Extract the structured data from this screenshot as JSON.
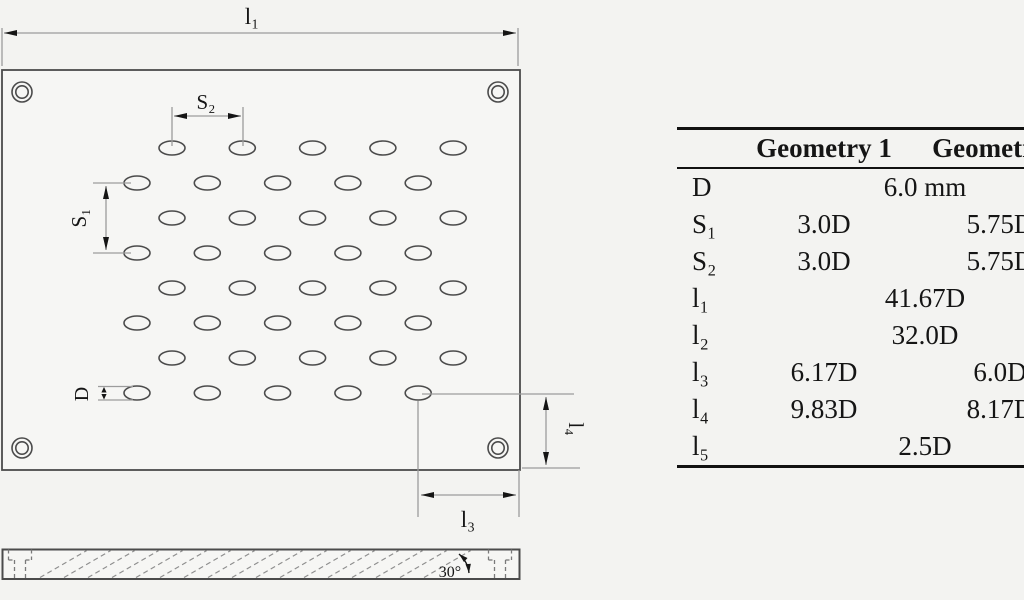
{
  "drawing": {
    "labels": {
      "l1": "l₁",
      "s2": "S₂",
      "s1": "S₁",
      "d": "D",
      "l4": "l₄",
      "l3": "l₃",
      "angle": "30°"
    },
    "plate": {
      "x": 2,
      "y": 70,
      "w": 518,
      "h": 400
    },
    "corner_holes": {
      "centers": [
        [
          22,
          92
        ],
        [
          498,
          92
        ],
        [
          22,
          448
        ],
        [
          498,
          448
        ]
      ],
      "r_outer": 10,
      "r_inner": 6.2
    },
    "hole_grid": {
      "row_count": 8,
      "col_count": 5,
      "y_start": 148,
      "y_pitch": 35,
      "x_start_a": 172,
      "x_start_b": 137,
      "x_pitch": 70.3,
      "rx": 13,
      "ry": 7
    },
    "side_view": {
      "x": 2,
      "y": 549,
      "w": 518,
      "h": 30
    },
    "hatch": {
      "x_from": 40,
      "x_to": 440,
      "step": 24,
      "dx": 46.8,
      "y_bottom": 577.5,
      "y_top": 550.5
    },
    "counterbores": {
      "centers_x": [
        20,
        500
      ],
      "outer_half": 11.5,
      "inner_half": 5.5,
      "y_top": 549.5,
      "y_mid": 560,
      "y_bottom": 578.5
    },
    "colors": {
      "outline": "#4b4b4b",
      "dim_line": "#9c9c9c",
      "ink": "#151515",
      "background": "#f3f3f1"
    }
  },
  "table": {
    "headers": {
      "g1": "Geometry 1",
      "g2": "Geometry 2"
    },
    "rows": [
      {
        "label": "D",
        "value": "6.0 mm"
      },
      {
        "label": "S₁",
        "g1": "3.0D",
        "g2": "5.75D"
      },
      {
        "label": "S₂",
        "g1": "3.0D",
        "g2": "5.75D"
      },
      {
        "label": "l₁",
        "value": "41.67D"
      },
      {
        "label": "l₂",
        "value": "32.0D"
      },
      {
        "label": "l₃",
        "g1": "6.17D",
        "g2": "6.0D"
      },
      {
        "label": "l₄",
        "g1": "9.83D",
        "g2": "8.17D"
      },
      {
        "label": "l₅",
        "value": "2.5D"
      }
    ]
  }
}
